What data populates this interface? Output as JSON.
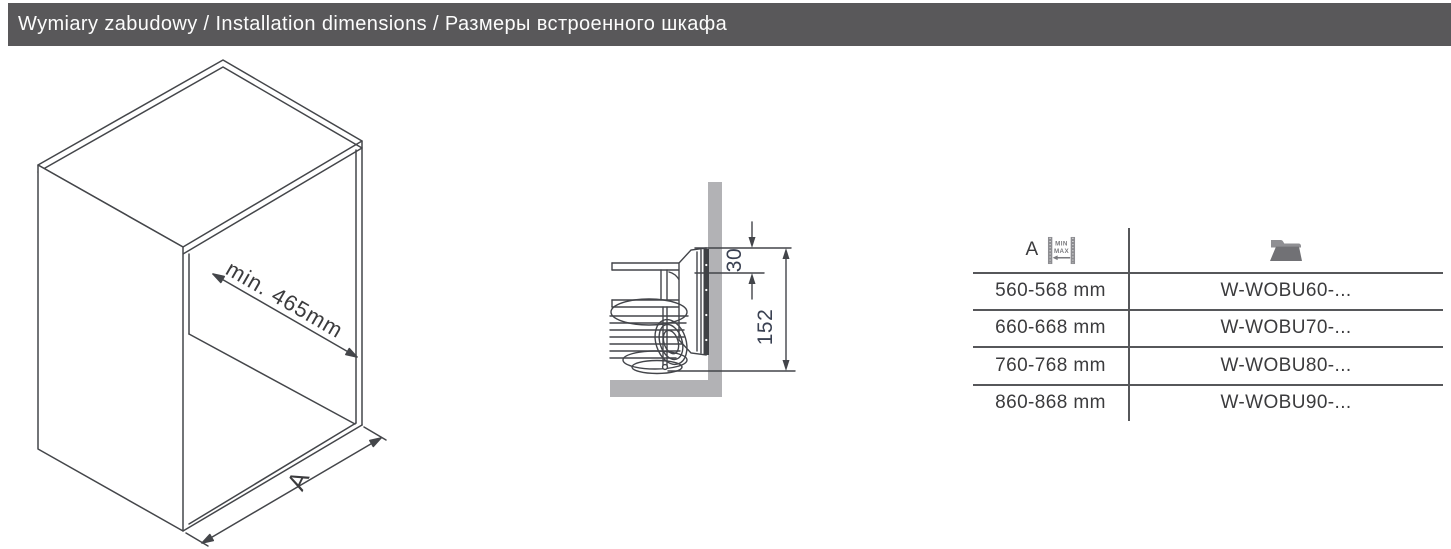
{
  "header": {
    "title": "Wymiary zabudowy / Installation dimensions / Размеры встроенного шкафа",
    "bg_color": "#59585a",
    "text_color": "#fcfcfc"
  },
  "cabinet_diagram": {
    "description": "isometric open cabinet line drawing",
    "depth_dimension": "min. 465mm",
    "width_dimension": "A"
  },
  "section_diagram": {
    "description": "side section of pull-out wire basket mounted on cabinet panel",
    "bracket_offset_mm": "30",
    "mount_height_mm": "152",
    "panel_color": "#b2b2b5",
    "line_color": "#43454a"
  },
  "table": {
    "col1_header": "A",
    "col1_icon": "min-max-width-icon",
    "col2_icon": "folder-icon",
    "rows": [
      {
        "a": "560-568 mm",
        "product": "W-WOBU60-..."
      },
      {
        "a": "660-668 mm",
        "product": "W-WOBU70-..."
      },
      {
        "a": "760-768 mm",
        "product": "W-WOBU80-..."
      },
      {
        "a": "860-868 mm",
        "product": "W-WOBU90-..."
      }
    ],
    "line_color": "#56575a"
  }
}
